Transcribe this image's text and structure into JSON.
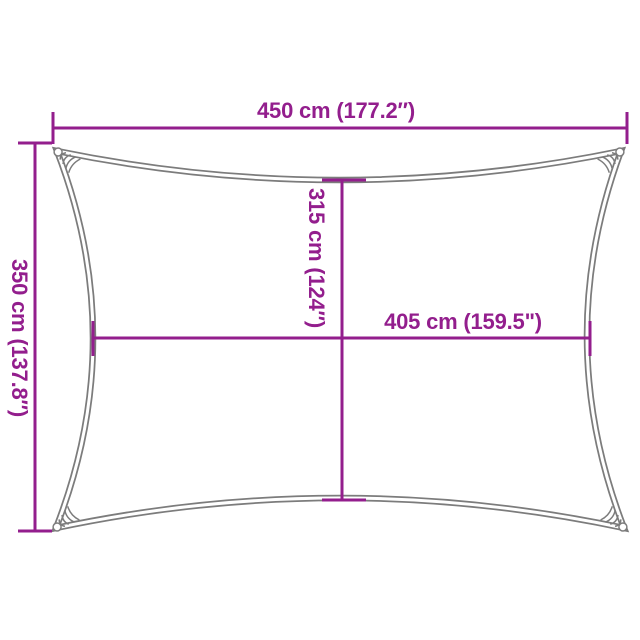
{
  "diagram": {
    "kind": "shade-sail-dimension-diagram",
    "colors": {
      "accent": "#931E8D",
      "sail_outline": "#7c7c7c",
      "background": "#ffffff"
    },
    "dimensions": {
      "top": {
        "label": "450 cm (177.2″)",
        "cm": 450,
        "inches": 177.2
      },
      "left": {
        "label": "350 cm (137.8″)",
        "cm": 350,
        "inches": 137.8
      },
      "middle_vertical": {
        "label": "315 cm (124″)",
        "cm": 315,
        "inches": 124
      },
      "middle_horizontal": {
        "label": "405 cm (159.5\")",
        "cm": 405,
        "inches": 159.5
      }
    }
  }
}
